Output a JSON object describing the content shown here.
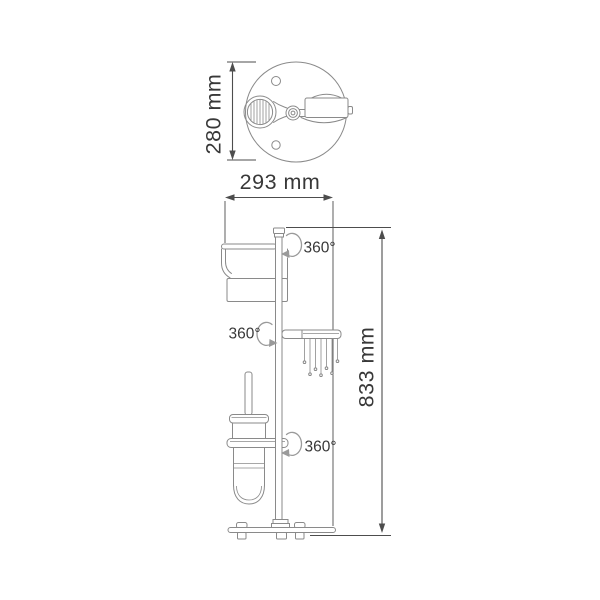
{
  "drawing": {
    "dimensions": {
      "plan_height": "280 mm",
      "plan_width": "293 mm",
      "overall_height": "833 mm"
    },
    "rotation": {
      "top": "360°",
      "middle": "360°",
      "bottom": "360°"
    },
    "colors": {
      "background": "#ffffff",
      "structure_line": "#8a8a8a",
      "dimension_line": "#4d4d4d",
      "text": "#383838"
    }
  }
}
